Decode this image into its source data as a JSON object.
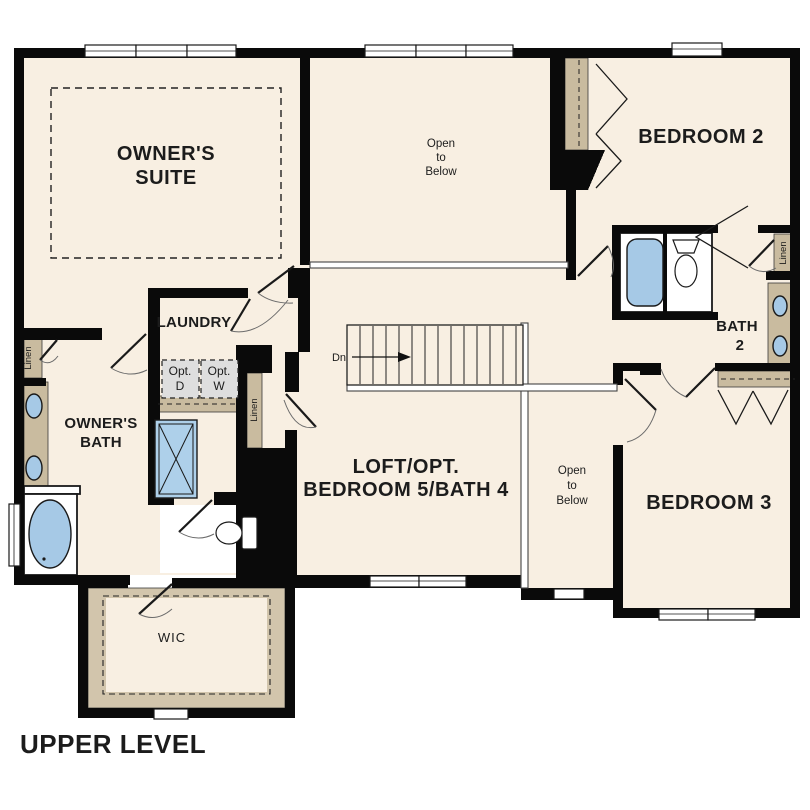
{
  "plan_title": "UPPER LEVEL",
  "rooms": {
    "owners_suite": {
      "line1": "OWNER'S",
      "line2": "SUITE"
    },
    "open_to_below_upper": {
      "line1": "Open",
      "line2": "to",
      "line3": "Below"
    },
    "bedroom_2": {
      "label": "BEDROOM 2"
    },
    "laundry": {
      "label": "LAUNDRY"
    },
    "owners_bath": {
      "line1": "OWNER'S",
      "line2": "BATH"
    },
    "bath_2": {
      "line1": "BATH",
      "line2": "2"
    },
    "loft": {
      "line1": "LOFT/OPT.",
      "line2": "BEDROOM 5/BATH 4"
    },
    "open_to_below_center": {
      "line1": "Open",
      "line2": "to",
      "line3": "Below"
    },
    "bedroom_3": {
      "label": "BEDROOM 3"
    },
    "wic": {
      "label": "WIC"
    }
  },
  "closets": {
    "linen_owners_hall": "Linen",
    "linen_upstairs_hall": "Linen",
    "linen_bath_2": "Linen"
  },
  "appliances": {
    "optional_dryer": {
      "line1": "Opt.",
      "line2": "D"
    },
    "optional_washer": {
      "line1": "Opt.",
      "line2": "W"
    }
  },
  "stairs": {
    "direction_label": "Dn"
  },
  "colors": {
    "floor": "#f8efe2",
    "wall": "#0a0a0a",
    "casework_tan": "#c9bb9f",
    "fixture_blue": "#a6c9e6",
    "appliance_gray": "#dedede",
    "background": "#ffffff"
  }
}
